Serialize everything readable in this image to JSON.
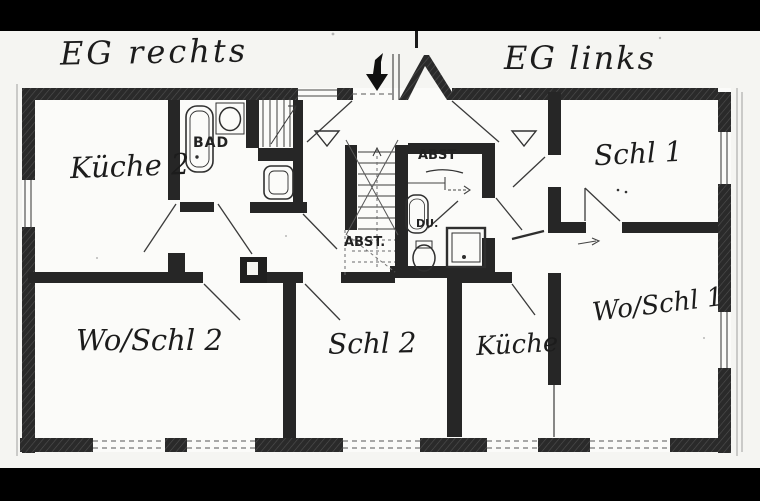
{
  "floorplan": {
    "title_left": "EG rechts",
    "title_right": "EG links",
    "labels": {
      "kueche2": "Küche 2",
      "bad": "BAD",
      "abst_upper": "ABST",
      "du": "DU.",
      "abst_lower": "ABST.",
      "schl1": "Schl 1",
      "wo_schl2": "Wo/Schl 2",
      "schl2": "Schl 2",
      "kueche": "Küche",
      "wo_schl1": "Wo/Schl 1"
    },
    "icons": {
      "entrance": "entrance-down-arrow-icon",
      "door_markers": "triangle-marker-icon",
      "fixtures": [
        "bathtub-icon",
        "washbasin-icon",
        "toilet-icon",
        "shower-tray-icon",
        "toilet-icon",
        "shower-icon"
      ],
      "stairs": [
        "main-staircase",
        "pantry-stairs"
      ]
    },
    "colors": {
      "wall": "#262626",
      "paper": "#f5f5f2",
      "letterbox": "#000000",
      "line": "#3a3a3a"
    }
  }
}
